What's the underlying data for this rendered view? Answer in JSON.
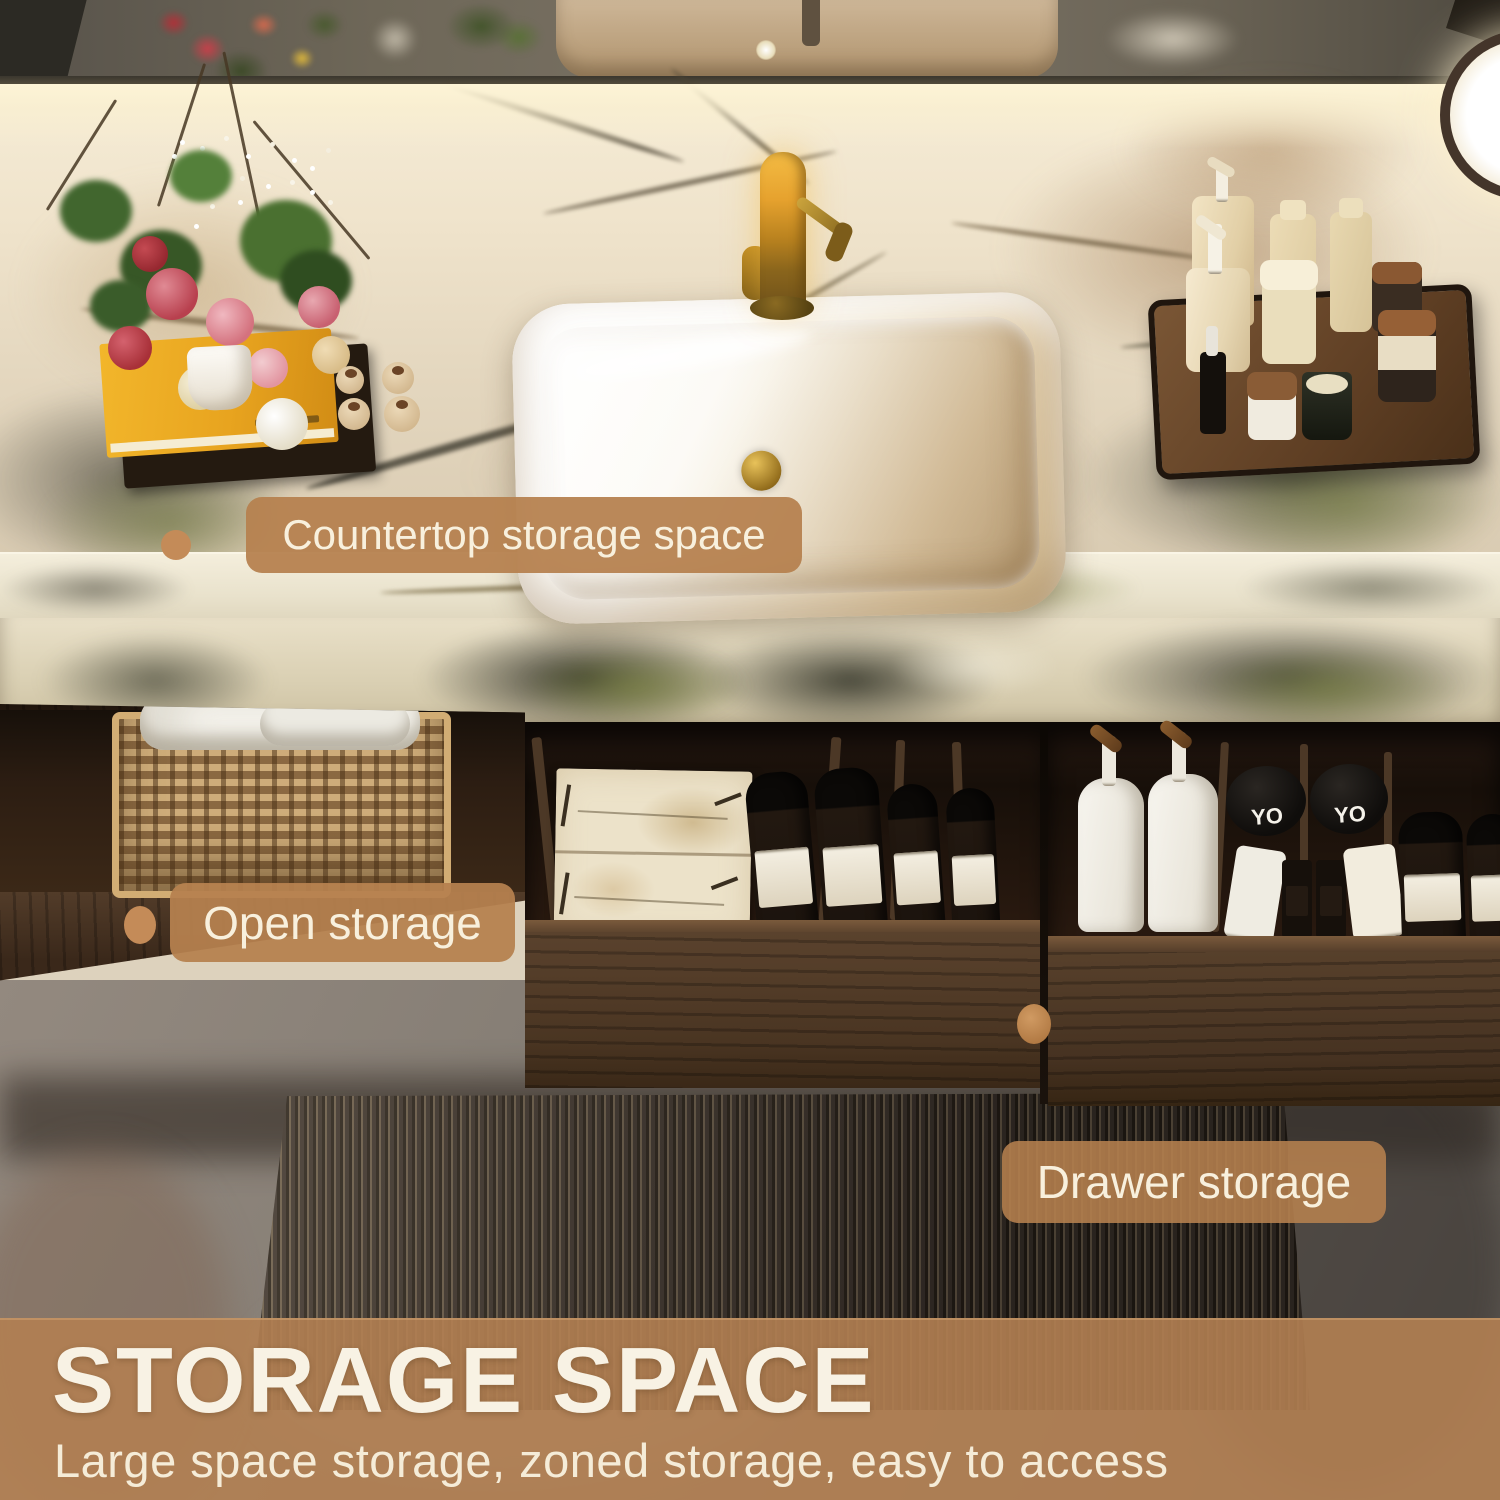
{
  "scene": {
    "description": "Product photo of a floating walnut bathroom vanity with marble countertop, vessel sink, open shelf and drawers, annotated with storage callouts"
  },
  "callouts": {
    "countertop": {
      "label": "Countertop storage space"
    },
    "open": {
      "label": "Open storage"
    },
    "drawer": {
      "label": "Drawer storage"
    }
  },
  "banner": {
    "title": "STORAGE SPACE",
    "subtitle": "Large space storage, zoned storage, easy to access"
  },
  "products": {
    "slipper_left_logo": "YO",
    "slipper_right_logo": "YO"
  },
  "colors": {
    "callout_bg": "#b6814f",
    "callout_text": "#f8f0dd",
    "banner_bg": "#b3814f",
    "banner_title": "#f8f2e4",
    "banner_subtitle": "#f5ecd8",
    "marker": "#c48b58"
  }
}
